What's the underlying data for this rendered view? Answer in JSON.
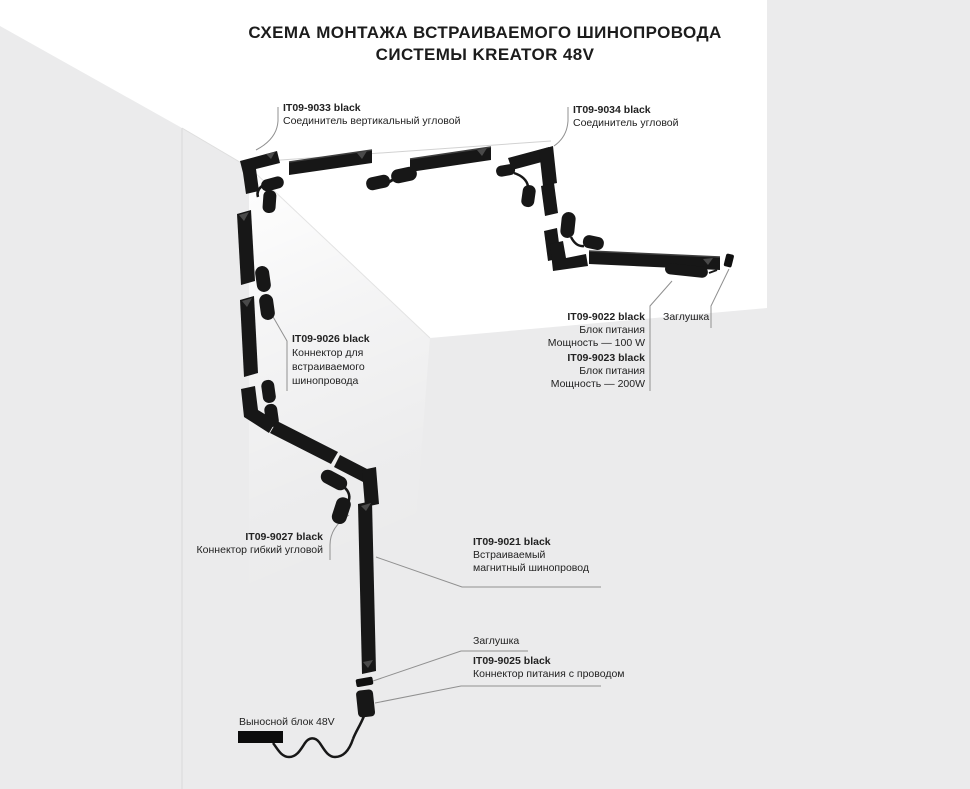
{
  "title": {
    "line1": "СХЕМА МОНТАЖА ВСТРАИВАЕМОГО ШИНОПРОВОДА",
    "line2": "СИСТЕМЫ KREATOR 48V"
  },
  "labels": {
    "it9033": {
      "part": "IT09-9033 black",
      "l1": "Соединитель вертикальный угловой"
    },
    "it9034": {
      "part": "IT09-9034 black",
      "l1": "Соединитель угловой"
    },
    "it9026": {
      "part": "IT09-9026 black",
      "l1": "Коннектор для",
      "l2": "встраиваемого",
      "l3": "шинопровода"
    },
    "it9022": {
      "part": "IT09-9022 black",
      "l1": "Блок питания",
      "l2": "Мощность — 100 W"
    },
    "it9023": {
      "part": "IT09-9023 black",
      "l1": "Блок питания",
      "l2": "Мощность — 200W"
    },
    "zaglushka_top": {
      "text": "Заглушка"
    },
    "it9027": {
      "part": "IT09-9027 black",
      "l1": "Коннектор гибкий угловой"
    },
    "it9021": {
      "part": "IT09-9021 black",
      "l1": "Встраиваемый",
      "l2": "магнитный шинопровод"
    },
    "zaglushka_bottom": {
      "text": "Заглушка"
    },
    "it9025": {
      "part": "IT09-9025 black",
      "l1": "Коннектор питания с проводом"
    },
    "remote_block": {
      "text": "Выносной блок 48V"
    }
  },
  "colors": {
    "wall_gray": "#ebebec",
    "ceiling_white": "#ffffff",
    "track_black": "#171717",
    "leader_line": "#909090",
    "text": "#1f1f1f",
    "remote_block": "#0c0c0c"
  }
}
